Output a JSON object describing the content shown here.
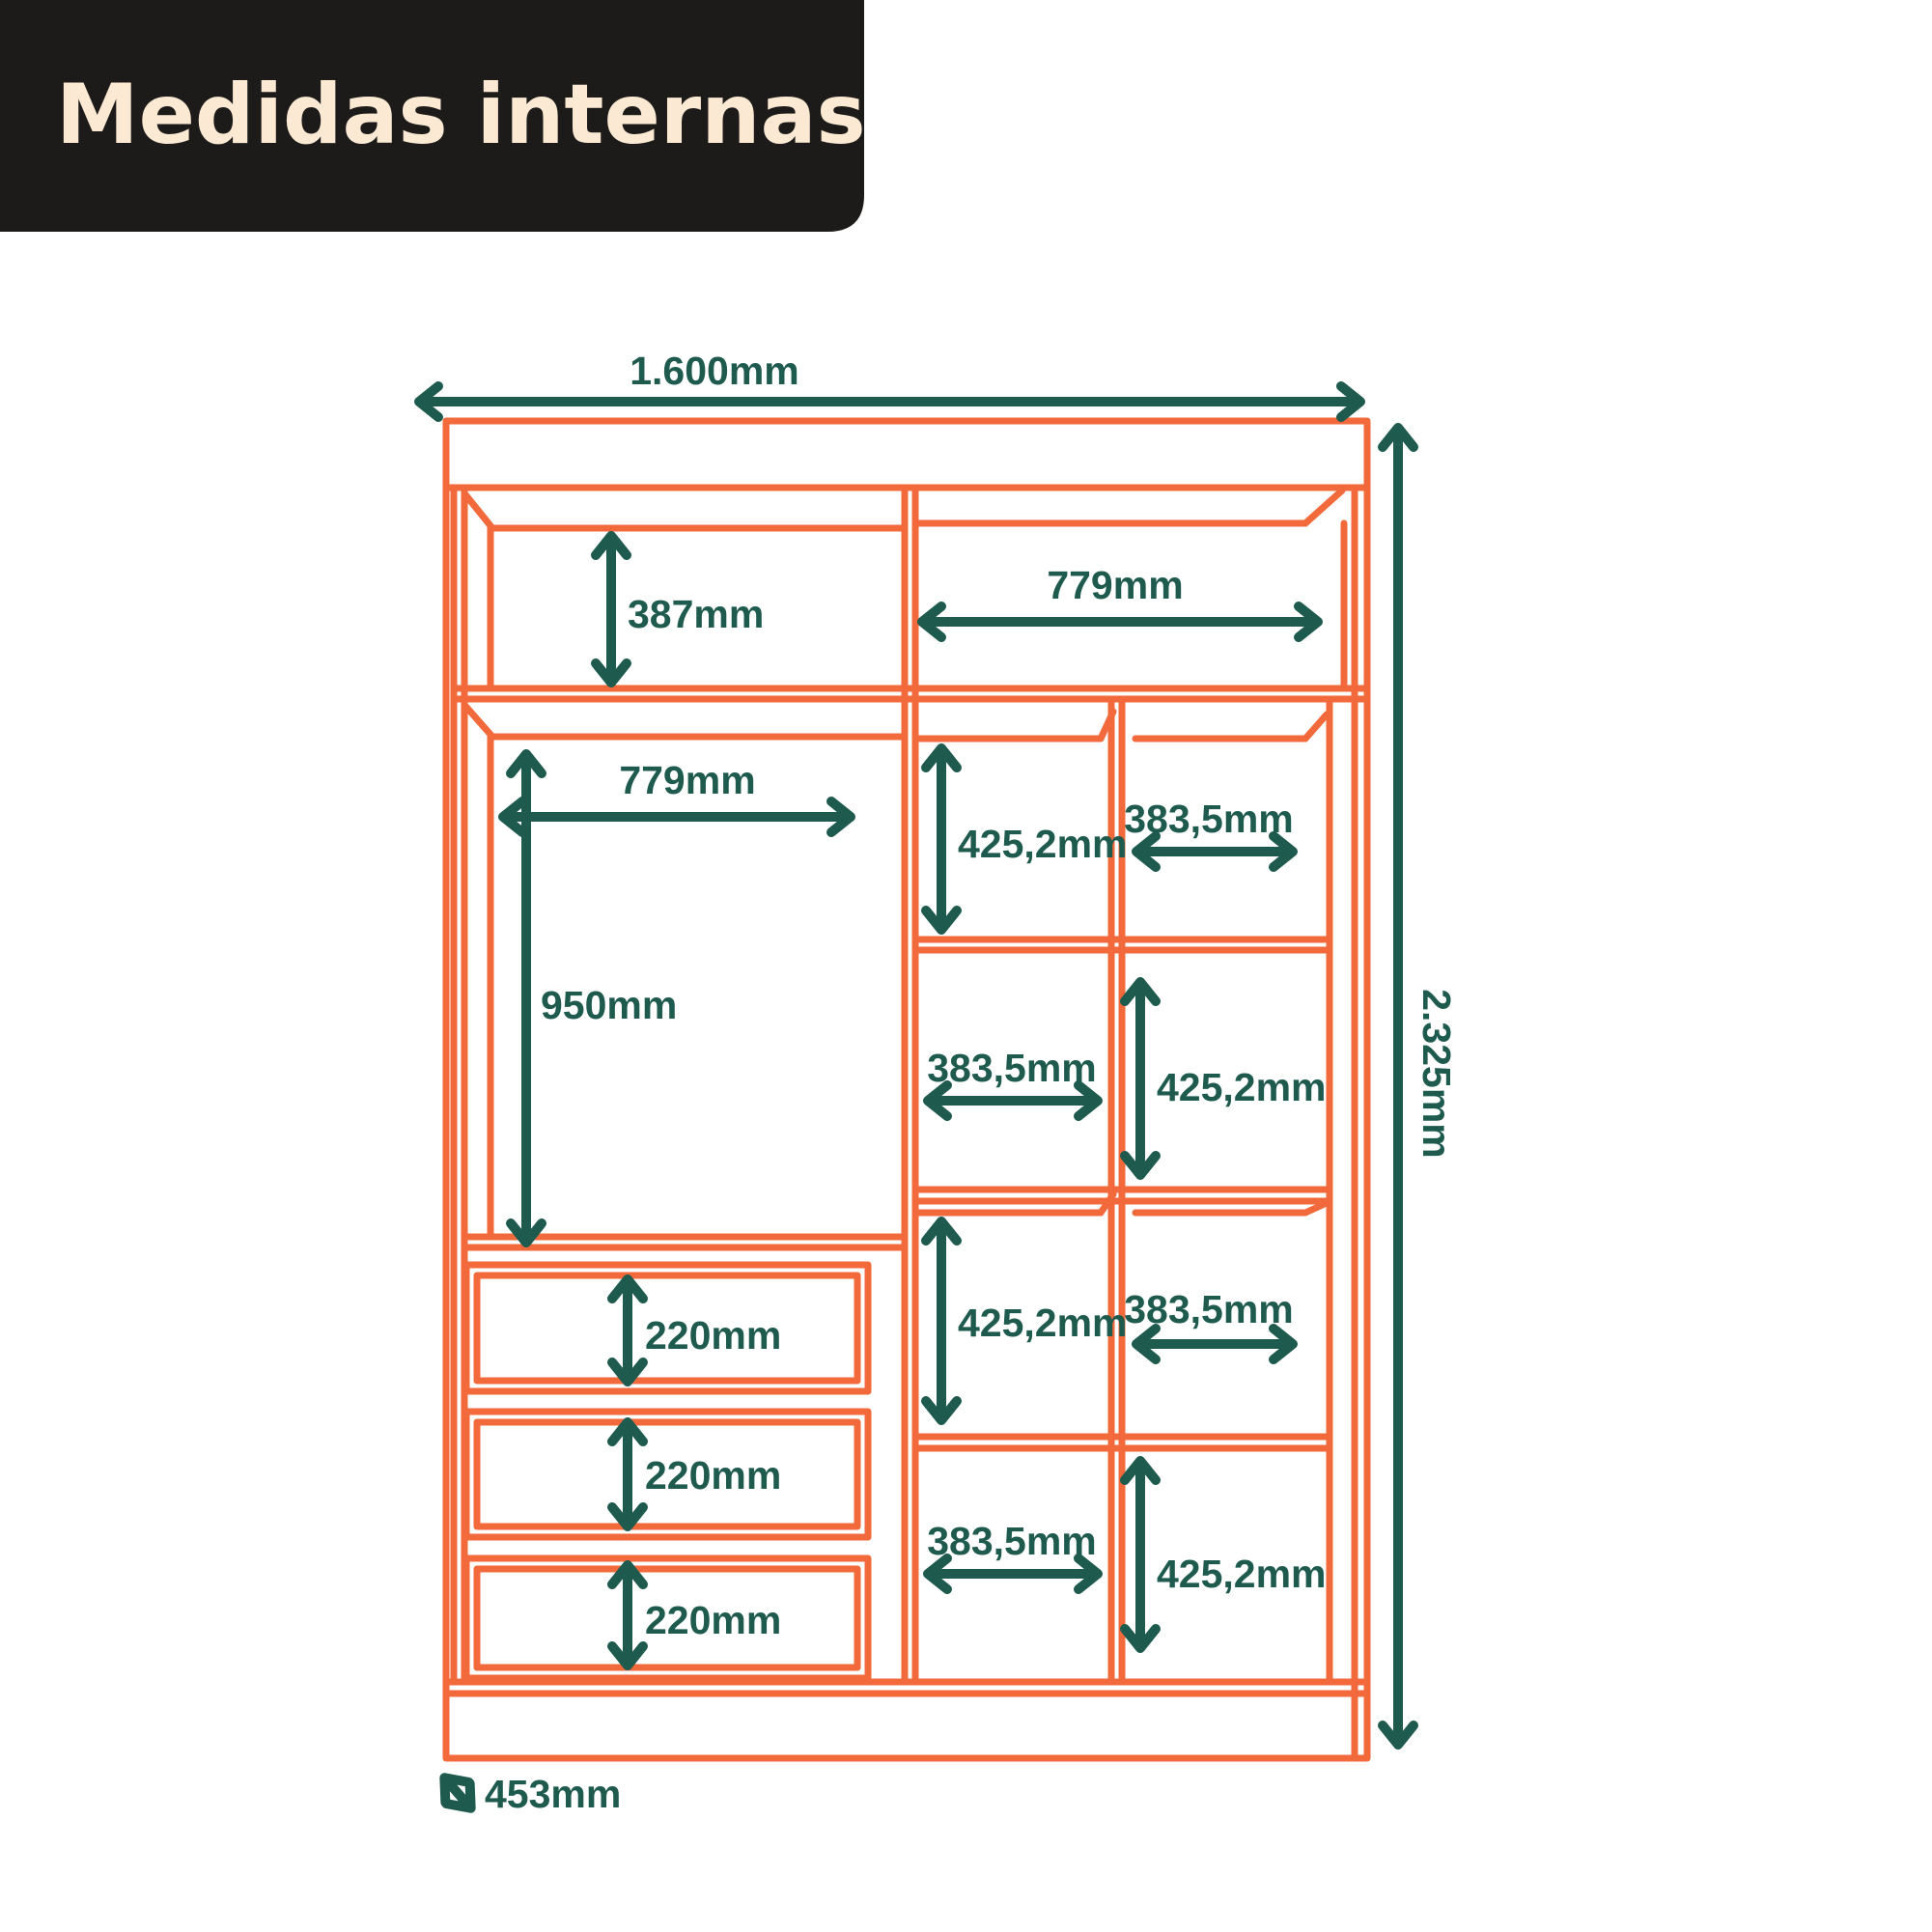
{
  "header": {
    "title": "Medidas internas"
  },
  "colors": {
    "outline_orange": "#F2693B",
    "dimension_teal": "#1E5B4E",
    "header_background": "#1D1B1A",
    "header_text": "#FBE9D3",
    "page_background": "#FFFFFF"
  },
  "diagram": {
    "type": "furniture-internal-dimensions",
    "labels": {
      "total_width": "1.600mm",
      "total_height": "2.325mm",
      "top_left_shelf_height": "387mm",
      "top_right_shelf_width": "779mm",
      "wardrobe_section_width": "779mm",
      "wardrobe_section_height": "950mm",
      "mid_col_cell1_height": "425,2mm",
      "right_col_cell1_width": "383,5mm",
      "mid_col_cell2_width": "383,5mm",
      "right_col_cell2_height": "425,2mm",
      "mid_col_cell3_height": "425,2mm",
      "right_col_cell3_width": "383,5mm",
      "mid_col_cell4_width": "383,5mm",
      "right_col_cell4_height": "425,2mm",
      "drawer1_height": "220mm",
      "drawer2_height": "220mm",
      "drawer3_height": "220mm",
      "depth": "453mm"
    }
  }
}
